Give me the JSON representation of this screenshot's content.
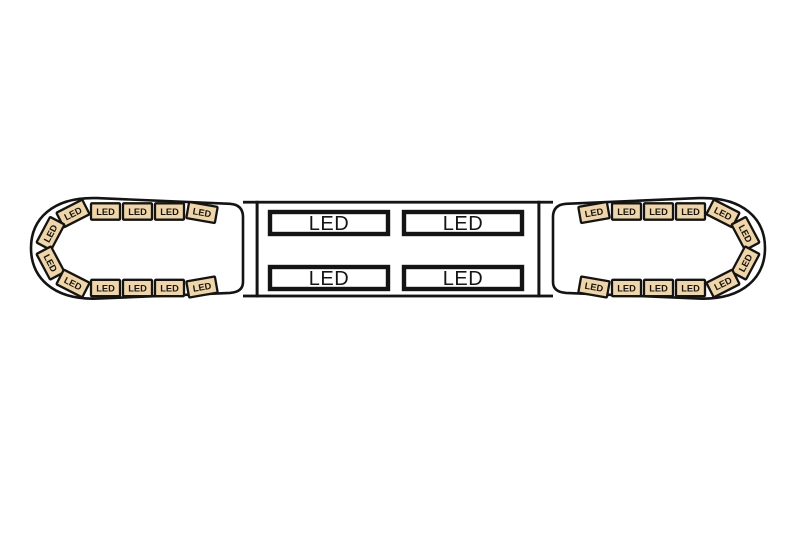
{
  "lightbar": {
    "module_label": "LED",
    "panel_label": "LED",
    "end_cap_module_count_each": 12,
    "total_small_modules": 24,
    "center_panel_count": 4,
    "colors": {
      "background": "#ffffff",
      "line": "#141414",
      "module_fill": "#f0d6a6",
      "panel_fill": "#ffffff"
    }
  }
}
